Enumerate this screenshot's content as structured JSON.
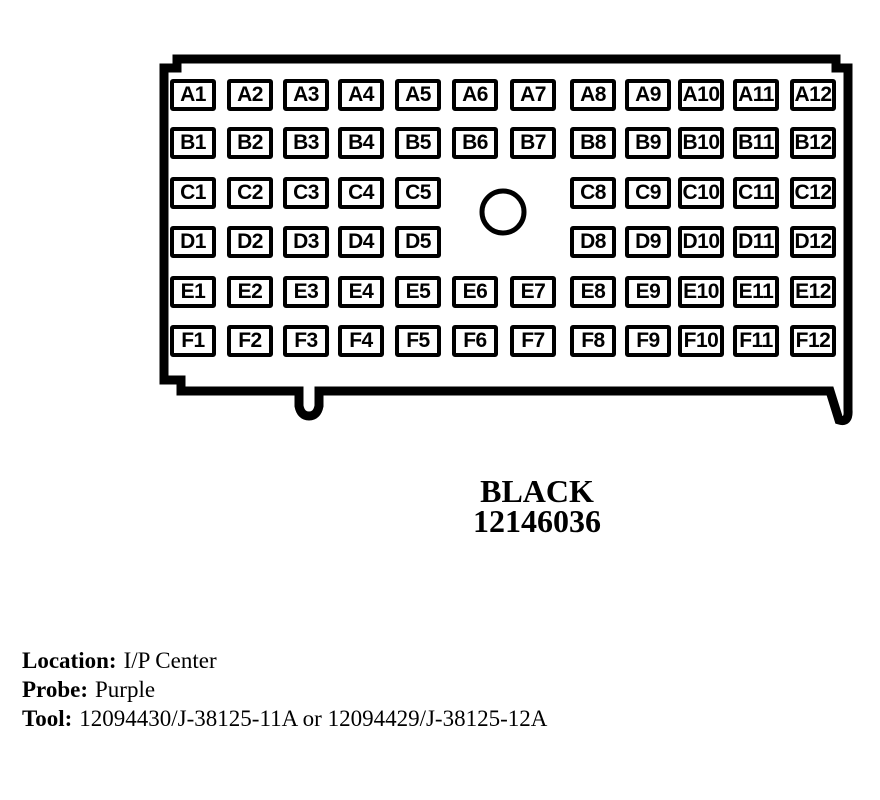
{
  "connector": {
    "color_name": "BLACK",
    "part_number": "12146036",
    "guide_hole": "round-guide-hole",
    "rows": [
      {
        "row": "A",
        "pins": [
          "A1",
          "A2",
          "A3",
          "A4",
          "A5",
          "A6",
          "A7",
          "A8",
          "A9",
          "A10",
          "A11",
          "A12"
        ]
      },
      {
        "row": "B",
        "pins": [
          "B1",
          "B2",
          "B3",
          "B4",
          "B5",
          "B6",
          "B7",
          "B8",
          "B9",
          "B10",
          "B11",
          "B12"
        ]
      },
      {
        "row": "C",
        "pins": [
          "C1",
          "C2",
          "C3",
          "C4",
          "C5",
          null,
          null,
          "C8",
          "C9",
          "C10",
          "C11",
          "C12"
        ]
      },
      {
        "row": "D",
        "pins": [
          "D1",
          "D2",
          "D3",
          "D4",
          "D5",
          null,
          null,
          "D8",
          "D9",
          "D10",
          "D11",
          "D12"
        ]
      },
      {
        "row": "E",
        "pins": [
          "E1",
          "E2",
          "E3",
          "E4",
          "E5",
          "E6",
          "E7",
          "E8",
          "E9",
          "E10",
          "E11",
          "E12"
        ]
      },
      {
        "row": "F",
        "pins": [
          "F1",
          "F2",
          "F3",
          "F4",
          "F5",
          "F6",
          "F7",
          "F8",
          "F9",
          "F10",
          "F11",
          "F12"
        ]
      }
    ]
  },
  "details": {
    "location_label": "Location:",
    "location_value": "I/P Center",
    "probe_label": "Probe:",
    "probe_value": "Purple",
    "tool_label": "Tool:",
    "tool_value": "12094430/J-38125-11A or 12094429/J-38125-12A"
  },
  "colors": {
    "line": "#000000",
    "background": "#ffffff"
  }
}
